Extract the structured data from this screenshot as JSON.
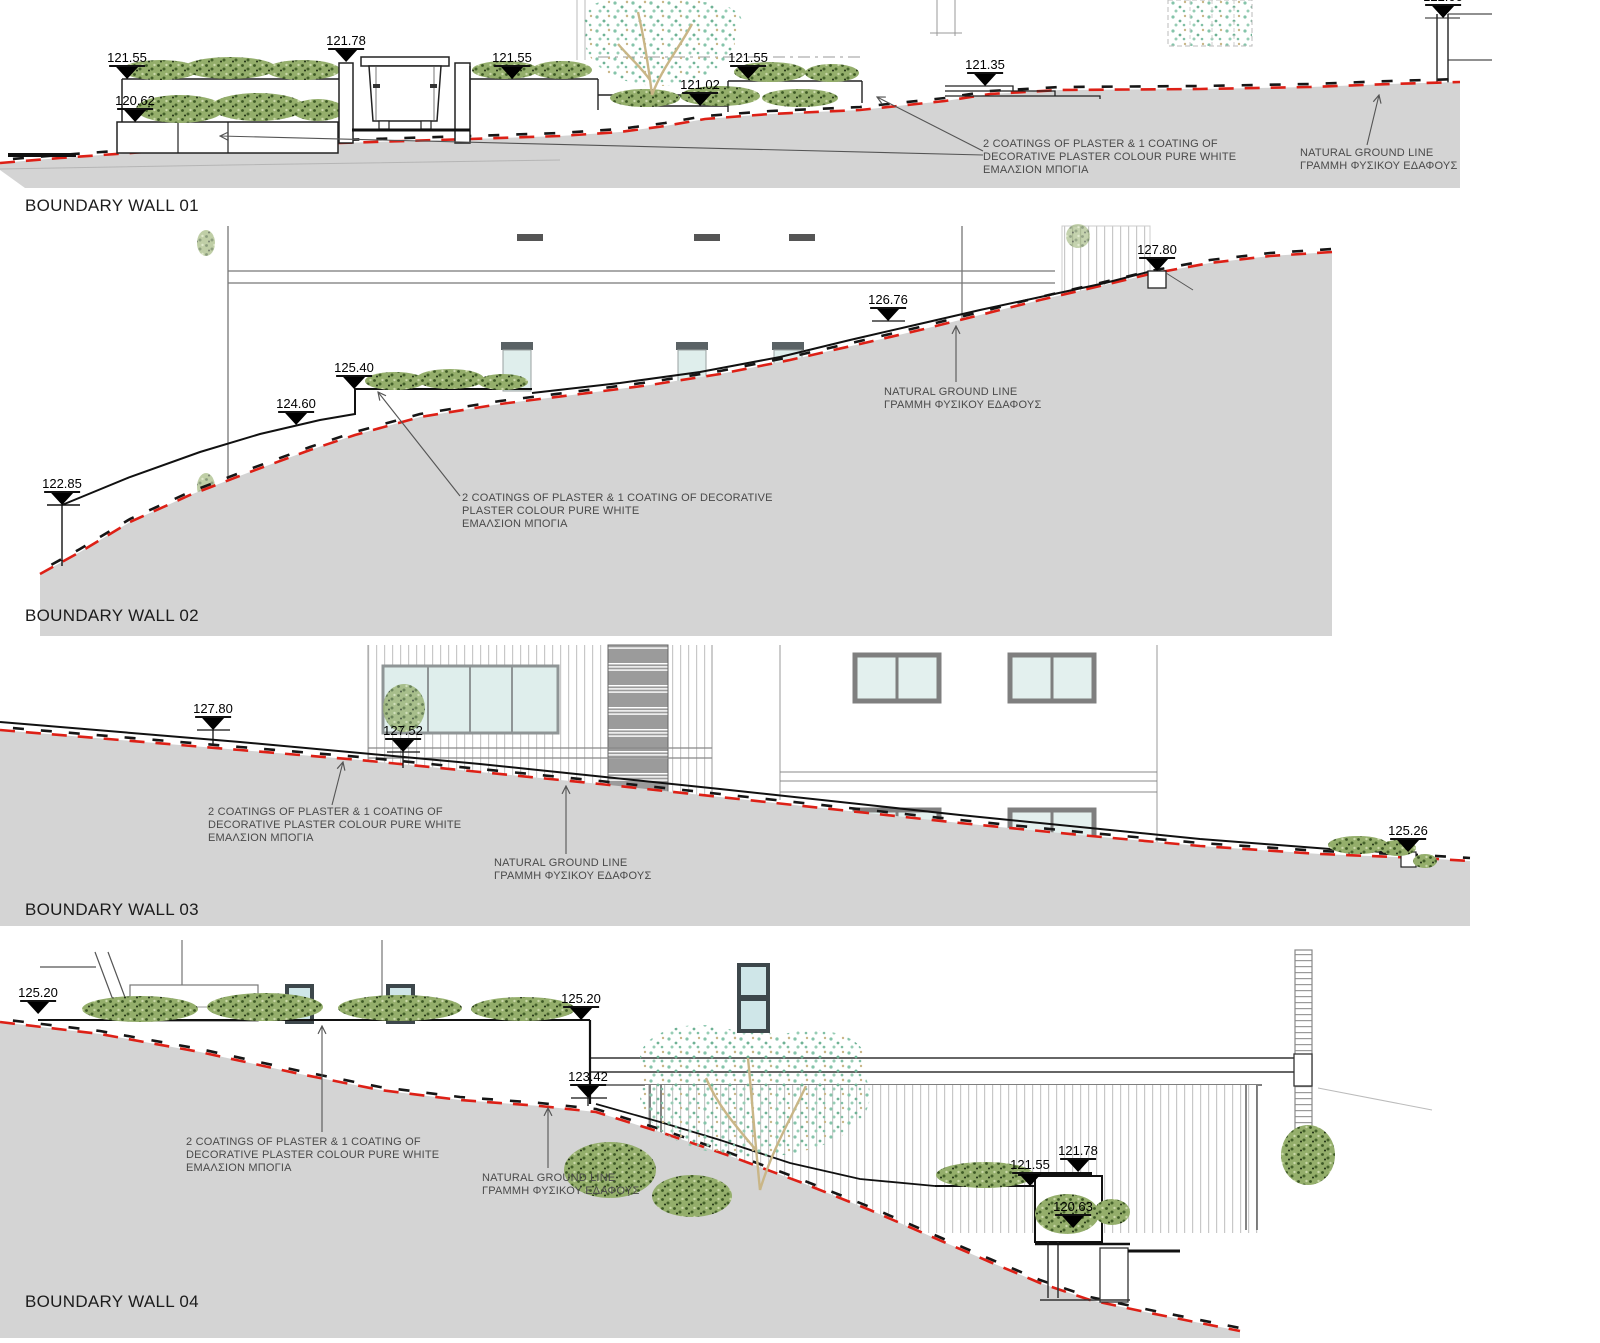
{
  "panels": [
    {
      "title": "BOUNDARY WALL 01",
      "markers": [
        {
          "label": "121.55"
        },
        {
          "label": "121.78"
        },
        {
          "label": "120.62"
        },
        {
          "label": "121.55"
        },
        {
          "label": "121.02"
        },
        {
          "label": "121.55"
        },
        {
          "label": "121.35"
        },
        {
          "label": "122.00"
        }
      ],
      "ann_plaster": "2 COATINGS OF PLASTER & 1 COATING OF\nDECORATIVE PLASTER COLOUR PURE WHITE\nΕΜΑΛΣΙΟΝ ΜΠΟΓΙΑ",
      "ann_ground": "NATURAL GROUND LINE\nΓΡΑΜΜΗ ΦΥΣΙΚΟΥ ΕΔΑΦΟΥΣ"
    },
    {
      "title": "BOUNDARY WALL 02",
      "markers": [
        {
          "label": "122.85"
        },
        {
          "label": "124.60"
        },
        {
          "label": "125.40"
        },
        {
          "label": "126.76"
        },
        {
          "label": "127.80"
        }
      ],
      "ann_plaster": "2 COATINGS OF PLASTER & 1 COATING OF DECORATIVE\nPLASTER COLOUR PURE WHITE\nΕΜΑΛΣΙΟΝ ΜΠΟΓΙΑ",
      "ann_ground": "NATURAL GROUND LINE\nΓΡΑΜΜΗ ΦΥΣΙΚΟΥ ΕΔΑΦΟΥΣ"
    },
    {
      "title": "BOUNDARY WALL 03",
      "markers": [
        {
          "label": "127.80"
        },
        {
          "label": "127.52"
        },
        {
          "label": "125.26"
        }
      ],
      "ann_plaster": "2 COATINGS OF PLASTER & 1 COATING OF\nDECORATIVE PLASTER COLOUR PURE WHITE\nΕΜΑΛΣΙΟΝ ΜΠΟΓΙΑ",
      "ann_ground": "NATURAL GROUND LINE\nΓΡΑΜΜΗ ΦΥΣΙΚΟΥ ΕΔΑΦΟΥΣ"
    },
    {
      "title": "BOUNDARY WALL 04",
      "markers": [
        {
          "label": "125.20"
        },
        {
          "label": "125.20"
        },
        {
          "label": "123.42"
        },
        {
          "label": "121.78"
        },
        {
          "label": "121.55"
        },
        {
          "label": "120.63"
        }
      ],
      "ann_plaster": "2 COATINGS OF PLASTER & 1 COATING OF\nDECORATIVE PLASTER COLOUR PURE WHITE\nΕΜΑΛΣΙΟΝ ΜΠΟΓΙΑ",
      "ann_ground": "NATURAL GROUND LINE\nΓΡΑΜΜΗ ΦΥΣΙΚΟΥ ΕΔΑΦΟΥΣ"
    }
  ],
  "colors": {
    "ground_fill": "#d4d4d4",
    "natural_line_red": "#dd2016",
    "wall_line_black": "#111111",
    "bush_green": "#94ae6b",
    "tree_teal": "#85c4aa",
    "glass_blue": "#dfeeec",
    "annotation_gray": "#4a4a4a"
  }
}
